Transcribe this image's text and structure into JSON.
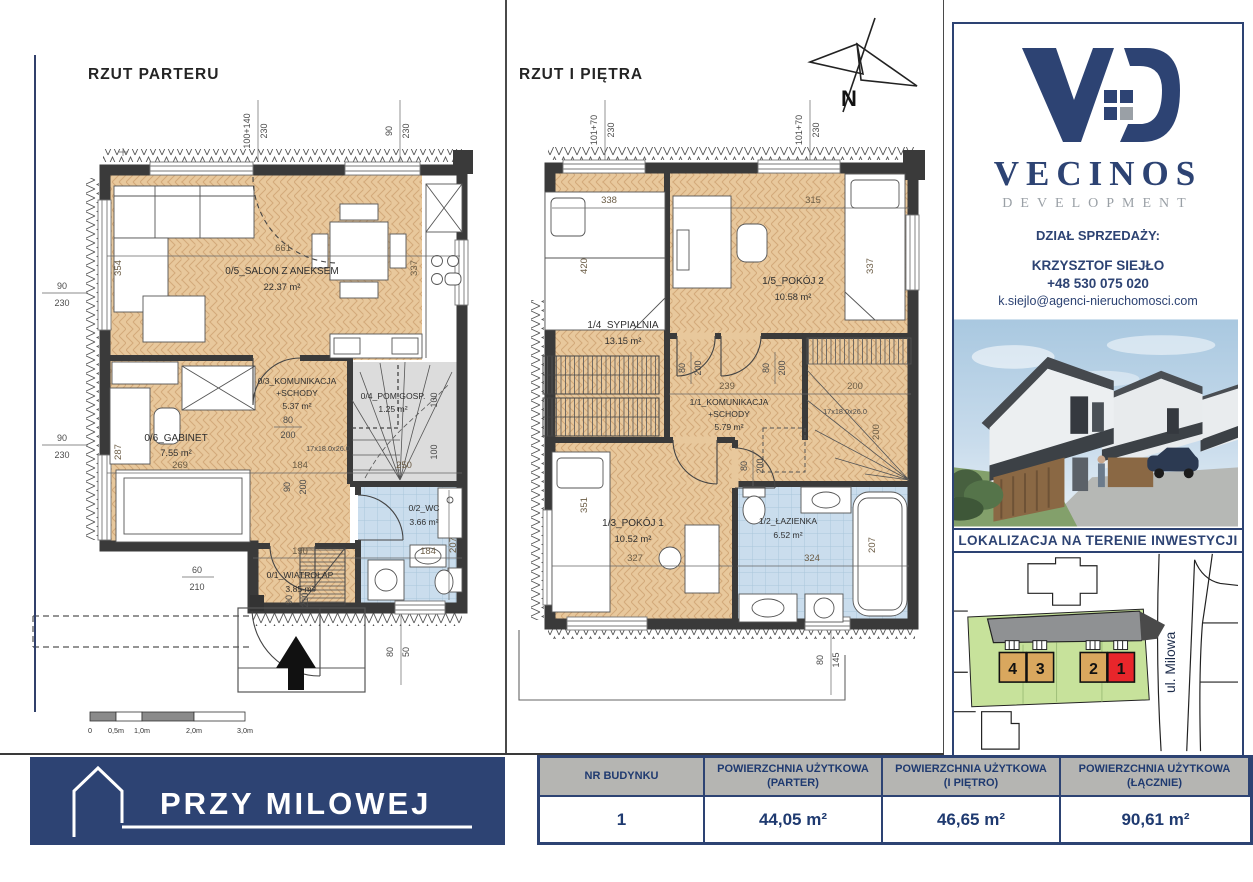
{
  "plans": {
    "ground": {
      "title": "RZUT PARTERU",
      "rooms": {
        "salon": {
          "name": "0/5_SALON Z ANEKSEM",
          "area": "22.37 m²"
        },
        "komunikacja": {
          "name": "0/3_KOMUNIKACJA",
          "name2": "+SCHODY",
          "area": "5.37 m²"
        },
        "pomgosp": {
          "name": "0/4_POM.GOSP.",
          "area": "1.25 m²"
        },
        "gabinet": {
          "name": "0/6_GABINET",
          "area": "7.55 m²"
        },
        "wc": {
          "name": "0/2_WC",
          "area": "3.66 m²"
        },
        "wiatrolap": {
          "name": "0/1_WIATROŁAP",
          "area": "3.85 m²"
        }
      },
      "dims": {
        "top1a": "100+140",
        "top1b": "230",
        "top2a": "90",
        "top2b": "230",
        "left1a": "90",
        "left1b": "230",
        "left2a": "90",
        "left2b": "230",
        "salon_w": "661",
        "salon_h": "354",
        "kitchen_h": "337",
        "gabinet_h": "287",
        "gabinet_w": "269",
        "kom_w": "184",
        "stairs_w": "250",
        "stairs_steps": "17x18.0x26.0",
        "flight1": "100",
        "flight2": "100",
        "door1a": "80",
        "door1b": "200",
        "door2a": "90",
        "door2b": "200",
        "entry_a": "60",
        "entry_b": "210",
        "door3a": "90",
        "door3b": "210",
        "wiatrolap_w": "190",
        "wc_w": "184",
        "wc_h": "207",
        "win_a": "80",
        "win_b": "50"
      }
    },
    "upper": {
      "title": "RZUT I PIĘTRA",
      "compass_label": "N",
      "rooms": {
        "sypialnia": {
          "name": "1/4_SYPIALNIA",
          "area": "13.15 m²"
        },
        "pokoj2": {
          "name": "1/5_POKÓJ 2",
          "area": "10.58 m²"
        },
        "komunikacja": {
          "name": "1/1_KOMUNIKACJA",
          "name2": "+SCHODY",
          "area": "5.79 m²"
        },
        "pokoj1": {
          "name": "1/3_POKÓJ 1",
          "area": "10.52 m²"
        },
        "lazienka": {
          "name": "1/2_ŁAZIENKA",
          "area": "6.52 m²"
        }
      },
      "dims": {
        "top1a": "101+70",
        "top1b": "230",
        "top2a": "101+70",
        "top2b": "230",
        "syp_w": "338",
        "pokoj2_w": "315",
        "syp_h": "420",
        "pokoj2_h": "337",
        "kom_w": "239",
        "stairs_w": "200",
        "stairs_steps": "17x18.0x26.0",
        "flight": "200",
        "pokoj1_h": "351",
        "pokoj1_w": "327",
        "laz_w": "324",
        "laz_h": "207",
        "door1a": "80",
        "door1b": "200",
        "door2a": "80",
        "door2b": "200",
        "door3a": "80",
        "door3b": "200",
        "win_a": "80",
        "win_b": "145"
      }
    }
  },
  "scalebar": {
    "l0": "0",
    "l1": "0,5m",
    "l2": "1,0m",
    "l3": "2,0m",
    "l4": "3,0m"
  },
  "sidebar": {
    "brand": "VECINOS",
    "brand_sub": "DEVELOPMENT",
    "sales_label": "DZIAŁ SPRZEDAŻY:",
    "contact_name": "KRZYSZTOF SIEJŁO",
    "contact_phone": "+48 530 075 020",
    "contact_email": "k.siejlo@agenci-nieruchomosci.com",
    "location_label": "LOKALIZACJA NA TERENIE INWESTYCJI",
    "map": {
      "street": "ul. Milowa",
      "unit1": "1",
      "unit2": "2",
      "unit3": "3",
      "unit4": "4"
    }
  },
  "footer": {
    "project_name": "PRZY MILOWEJ",
    "table": {
      "h1": "NR BUDYNKU",
      "h2a": "POWIERZCHNIA UŻYTKOWA",
      "h2b": "(PARTER)",
      "h3a": "POWIERZCHNIA UŻYTKOWA",
      "h3b": "(I PIĘTRO)",
      "h4a": "POWIERZCHNIA UŻYTKOWA",
      "h4b": "(ŁĄCZNIE)",
      "building_no": "1",
      "area_parter": "44,05 m²",
      "area_pietro": "46,65 m²",
      "area_total": "90,61 m²"
    }
  },
  "colors": {
    "navy": "#2d4373",
    "wood": "#e8c89c",
    "bath_blue": "#cadded",
    "wall": "#3a3a3a",
    "map_green": "#c7e29b",
    "map_tan": "#d9a75e",
    "map_red": "#e8262b"
  }
}
